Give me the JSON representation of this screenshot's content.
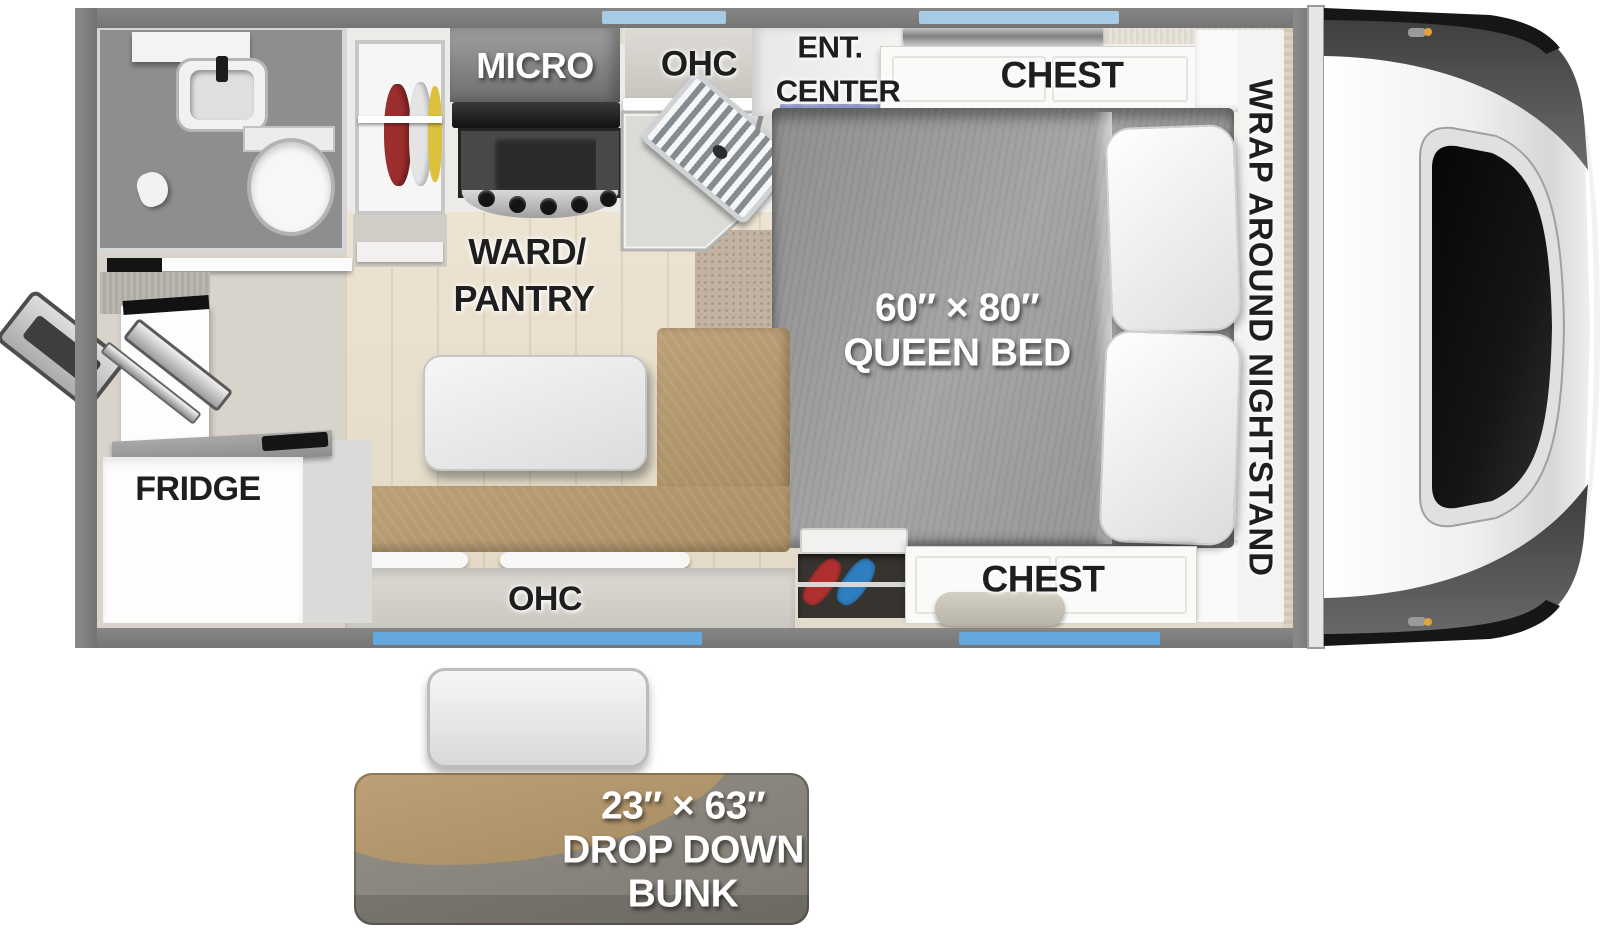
{
  "title": "Truck camper floorplan with drop down bunk",
  "colors": {
    "wall": "#7a7a7a",
    "window_top": "#a6cbe7",
    "window_bottom": "#63a9e0",
    "bench_tan": "#b2966c",
    "bed_gray": "#a0a0a0",
    "bunk_tan": "#b2966c",
    "bunk_gray": "#8b8680",
    "floor_wood": "#e6dccb",
    "ent_accent": "#8b93c4"
  },
  "labels": {
    "micro": "MICRO",
    "ohc_top": "OHC",
    "ent_center": {
      "line1": "ENT.",
      "line2": "CENTER"
    },
    "chest_top": "CHEST",
    "wrap_nightstand": "WRAP AROUND NIGHTSTAND",
    "ward_pantry": {
      "line1": "WARD/",
      "line2": "PANTRY"
    },
    "queen_bed": {
      "line1": "60″ × 80″",
      "line2": "QUEEN BED"
    },
    "fridge": "FRIDGE",
    "ohc_bottom": "OHC",
    "chest_bottom": "CHEST",
    "drop_down_bunk": {
      "line1": "23″ × 63″",
      "line2": "DROP DOWN",
      "line3": "BUNK"
    }
  }
}
